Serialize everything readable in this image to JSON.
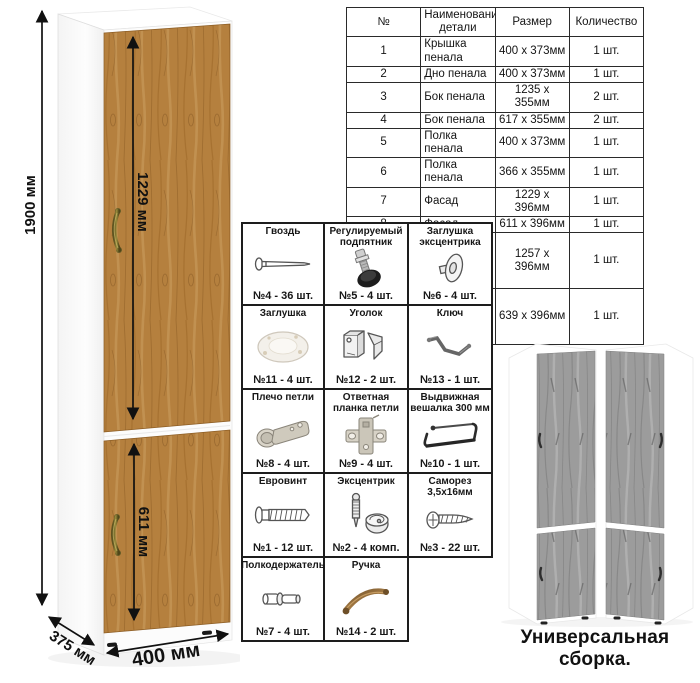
{
  "parts_table": {
    "headers": [
      "№",
      "Наименование детали",
      "Размер",
      "Количество"
    ],
    "rows": [
      [
        "1",
        "Крышка пенала",
        "400 х 373мм",
        "1 шт."
      ],
      [
        "2",
        "Дно пенала",
        "400 х 373мм",
        "1 шт."
      ],
      [
        "3",
        "Бок пенала",
        "1235 х 355мм",
        "2 шт."
      ],
      [
        "4",
        "Бок пенала",
        "617 х 355мм",
        "2 шт."
      ],
      [
        "5",
        "Полка пенала",
        "400 х 373мм",
        "1 шт."
      ],
      [
        "6",
        "Полка пенала",
        "366 х 355мм",
        "1 шт."
      ],
      [
        "7",
        "Фасад",
        "1229 х 396мм",
        "1 шт."
      ],
      [
        "8",
        "Фасад",
        "611 х 396мм",
        "1 шт."
      ],
      [
        "9",
        "ДВП – задняя стенка пенала",
        "1257 х 396мм",
        "1 шт."
      ],
      [
        "10",
        "ДВП – задняя стенка пенала",
        "639 х 396мм",
        "1 шт."
      ]
    ]
  },
  "hardware": {
    "items": [
      {
        "name": "Гвоздь",
        "qty": "№4 - 36 шт.",
        "icon": "nail-icon"
      },
      {
        "name": "Регулируемый подпятник",
        "qty": "№5 - 4 шт.",
        "icon": "adjustable-foot-icon"
      },
      {
        "name": "Заглушка эксцентрика",
        "qty": "№6 - 4 шт.",
        "icon": "cam-cover-icon"
      },
      {
        "name": "Заглушка",
        "qty": "№11 - 4 шт.",
        "icon": "cap-icon"
      },
      {
        "name": "Уголок",
        "qty": "№12 - 2 шт.",
        "icon": "corner-bracket-icon"
      },
      {
        "name": "Ключ",
        "qty": "№13 - 1 шт.",
        "icon": "hex-key-icon"
      },
      {
        "name": "Плечо петли",
        "qty": "№8 - 4 шт.",
        "icon": "hinge-arm-icon"
      },
      {
        "name": "Ответная планка петли",
        "qty": "№9 - 4 шт.",
        "icon": "hinge-plate-icon"
      },
      {
        "name": "Выдвижная вешалка 300 мм",
        "qty": "№10 - 1 шт.",
        "icon": "pullout-hanger-icon"
      },
      {
        "name": "Евровинт",
        "qty": "№1 - 12 шт.",
        "icon": "euro-screw-icon"
      },
      {
        "name": "Эксцентрик",
        "qty": "№2 - 4 комп.",
        "icon": "cam-lock-icon"
      },
      {
        "name": "Саморез 3,5х16мм",
        "qty": "№3 - 22 шт.",
        "icon": "self-tapping-screw-icon"
      },
      {
        "name": "Полкодержатель",
        "qty": "№7 - 4 шт.",
        "icon": "shelf-pin-icon"
      },
      {
        "name": "Ручка",
        "qty": "№14 - 2 шт.",
        "icon": "handle-icon"
      }
    ]
  },
  "dimensions": {
    "height": "1900 мм",
    "upper_door": "1229 мм",
    "lower_door": "611 мм",
    "depth": "375 мм",
    "width": "400 мм"
  },
  "footer": {
    "caption": "Универсальная сборка."
  },
  "colors": {
    "wood_base": "#b5803e",
    "wood_dark": "#8a5a22",
    "wood_light": "#d4a867",
    "gray_wood": "#9c9c9c",
    "white_body": "#ffffff",
    "line": "#111111",
    "brass_handle": "#7d6e2e"
  }
}
